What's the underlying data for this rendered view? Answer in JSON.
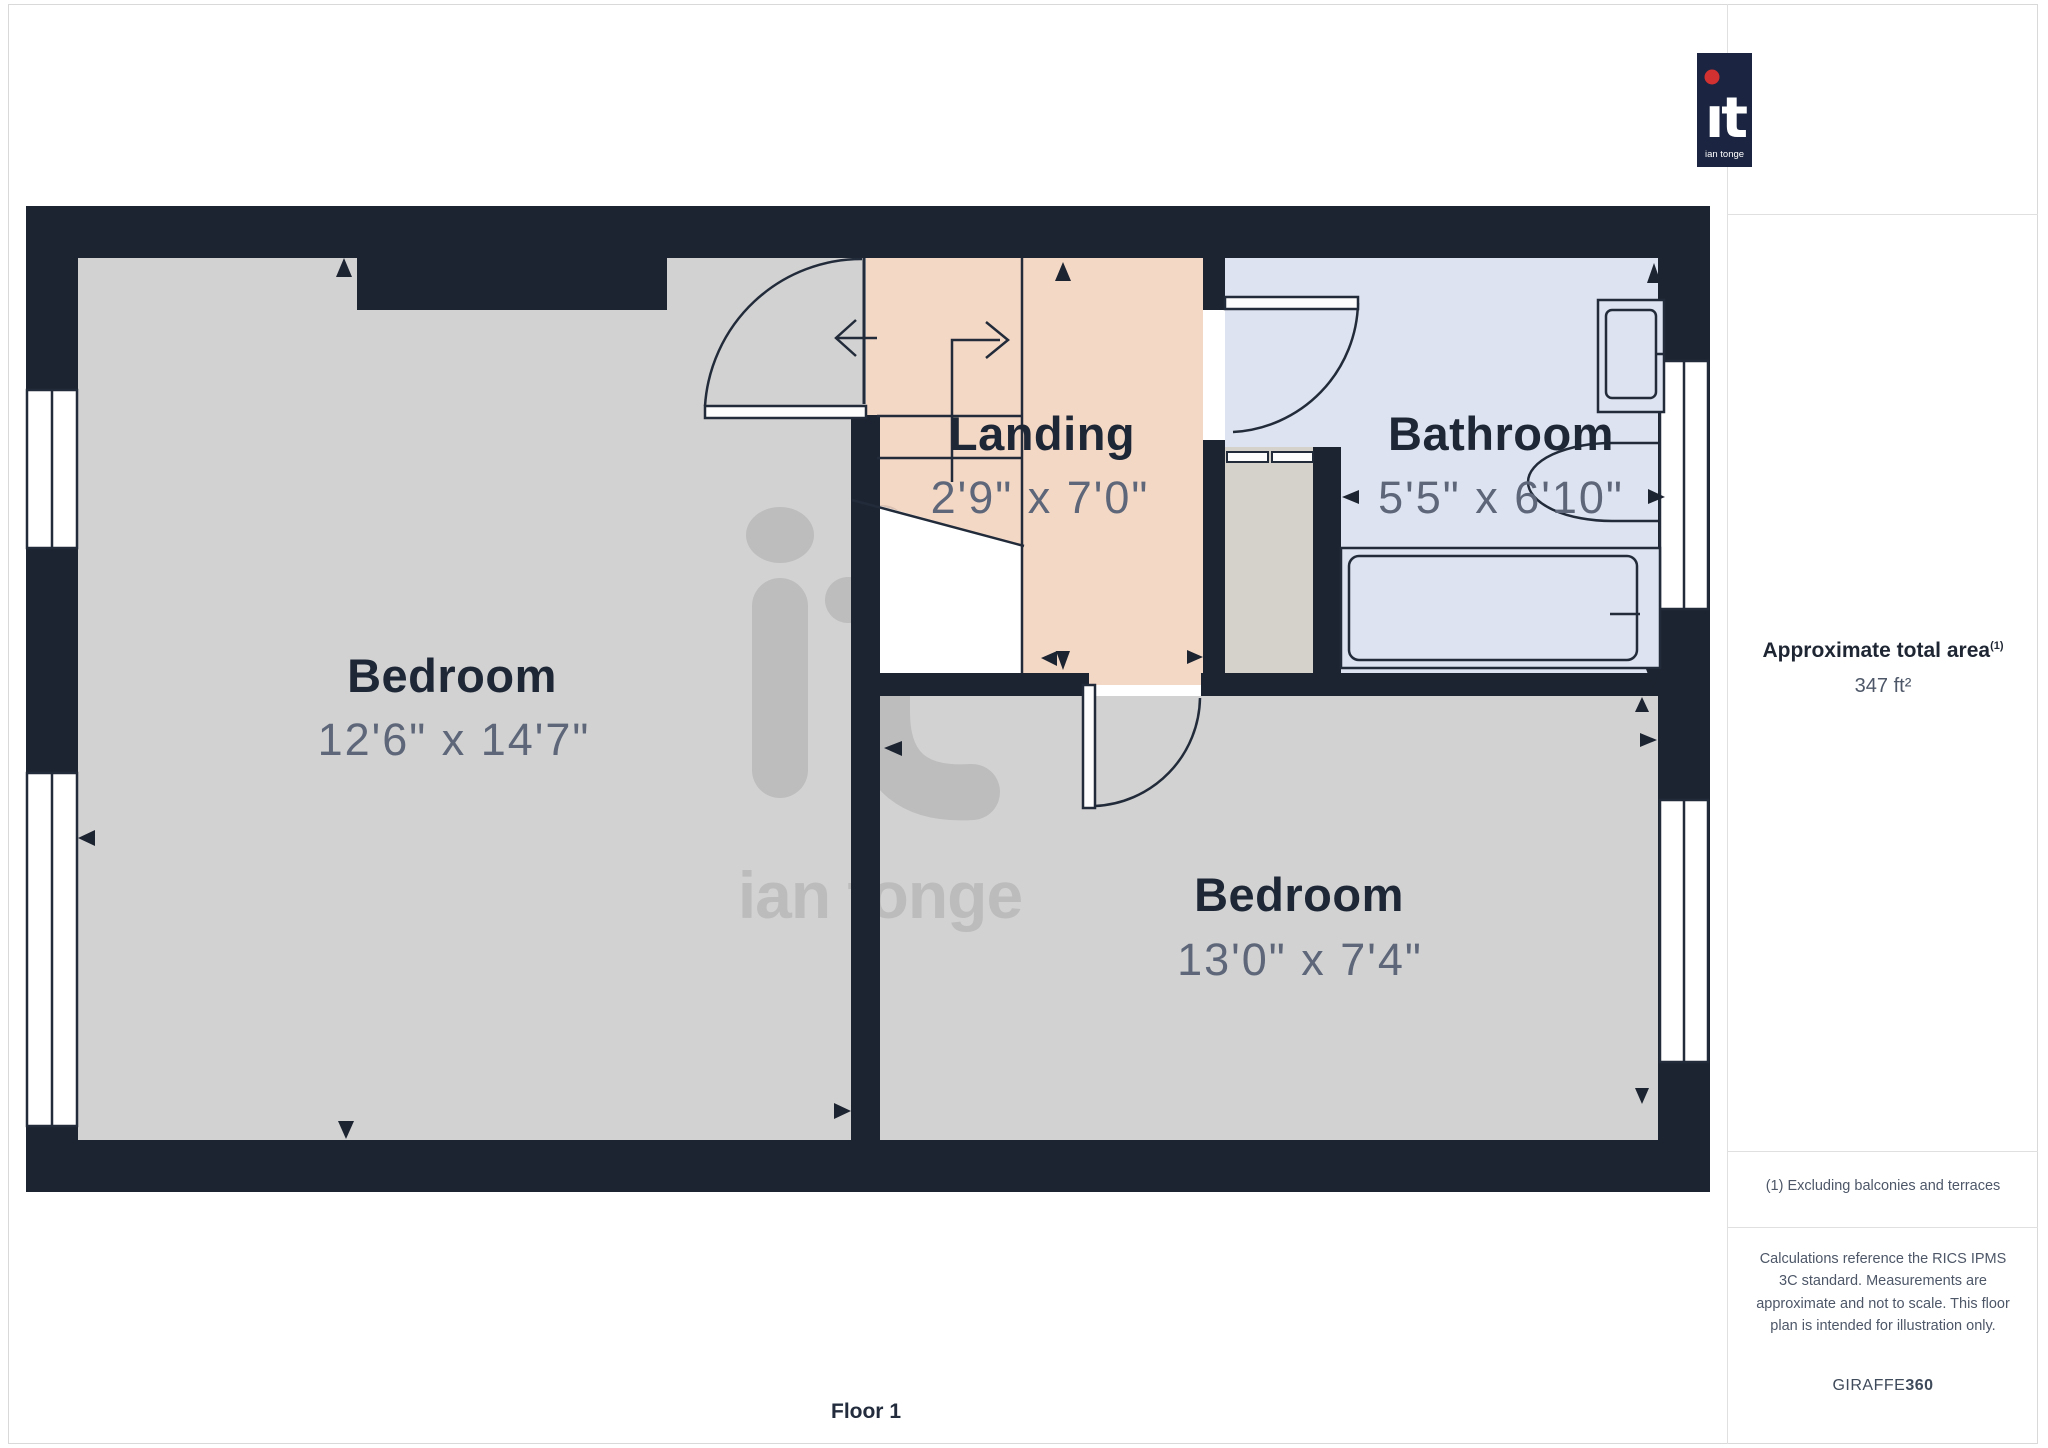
{
  "floor_plan": {
    "floor_label": "Floor 1",
    "rooms": [
      {
        "name": "Bedroom",
        "dimensions": "12'6\" x 14'7\""
      },
      {
        "name": "Landing",
        "dimensions": "2'9\" x 7'0\""
      },
      {
        "name": "Bathroom",
        "dimensions": "5'5\" x 6'10\""
      },
      {
        "name": "Bedroom",
        "dimensions": "13'0\" x 7'4\""
      }
    ],
    "watermark": "ian tonge"
  },
  "sidebar": {
    "logo": {
      "brand": "it",
      "sub": "ian tonge"
    },
    "area": {
      "heading": "Approximate total area",
      "superscript": "(1)",
      "value": "347 ft²"
    },
    "footnote": "(1) Excluding balconies and terraces",
    "disclaimer": "Calculations reference the RICS IPMS 3C standard. Measurements are approximate and not to scale. This floor plan is intended for illustration only.",
    "credit": {
      "brand": "GIRAFFE",
      "suffix": "360"
    }
  },
  "colors": {
    "wall": "#1d2431",
    "bedroom_floor": "#d2d2d2",
    "landing_floor": "#f4d8c6",
    "bathroom_floor": "#dde3f0",
    "cupboard_floor": "#d5d2cb",
    "line": "#222b3a",
    "label_text": "#1e2736",
    "dimension_text": "#5d6779",
    "logo_navy": "#1b2440",
    "logo_red": "#d23131"
  }
}
